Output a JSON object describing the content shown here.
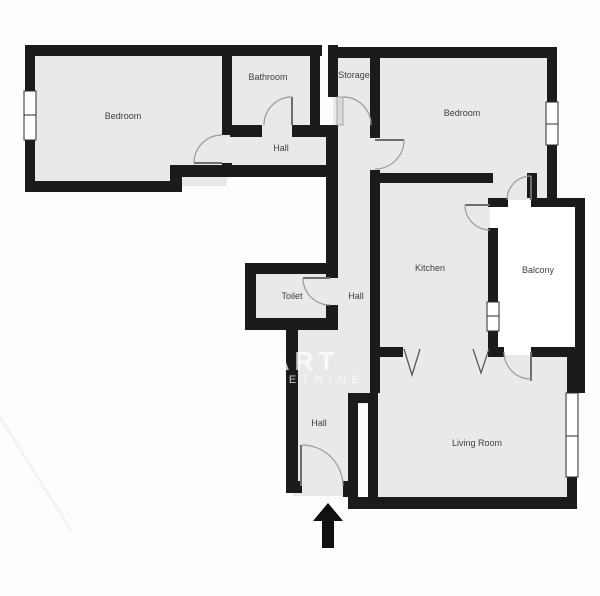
{
  "title": "Apartment floor plan",
  "colors": {
    "wall": "#1b1b1b",
    "room_fill": "#e9e9e9",
    "balcony_fill": "#ffffff",
    "background": "#fdfdfd",
    "door_arc": "#9a9a9a",
    "label_text": "#3e3e3e",
    "watermark": "#ffffff"
  },
  "rooms": {
    "bedroom_left": "Bedroom",
    "bathroom": "Bathroom",
    "storage": "Storage",
    "hall_upper": "Hall",
    "bedroom_right": "Bedroom",
    "kitchen": "Kitchen",
    "balcony": "Balcony",
    "toilet": "Toilet",
    "hall_middle": "Hall",
    "hall_lower": "Hall",
    "living_room": "Living Room"
  },
  "watermark": {
    "line1": "ART",
    "line2": "ETNINE"
  },
  "icons": {
    "entrance_arrow": "up-arrow"
  }
}
